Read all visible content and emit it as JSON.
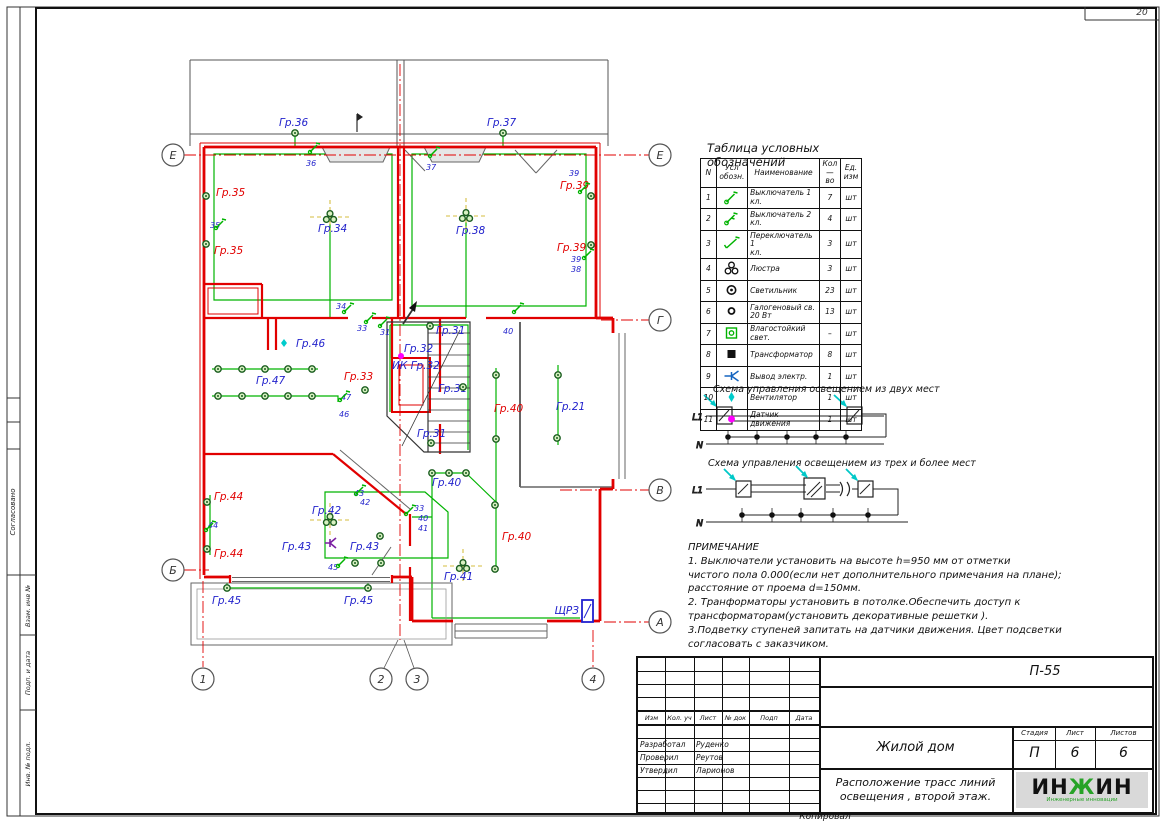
{
  "page": {
    "corner_number": "20",
    "copied_label": "Копировал"
  },
  "sidebar": {
    "agreed": "Согласовано",
    "vzam": "Взам. инв №",
    "podp": "Подп. и дата",
    "inv": "Инв. № подл."
  },
  "legend": {
    "title": "Таблица условных обозначений",
    "headers": {
      "n": "N",
      "symbol": "Усл\nобозн.",
      "name": "Наименование",
      "qty": "Кол\n—\nво",
      "unit": "Ед.\nизм"
    },
    "rows": [
      {
        "n": "1",
        "icon": "switch-1",
        "name": "Выключатель 1\nкл.",
        "qty": "7",
        "unit": "шт"
      },
      {
        "n": "2",
        "icon": "switch-2",
        "name": "Выключатель 2\nкл.",
        "qty": "4",
        "unit": "шт"
      },
      {
        "n": "3",
        "icon": "changeover",
        "name": "Переключатель 1\nкл.",
        "qty": "3",
        "unit": "шт"
      },
      {
        "n": "4",
        "icon": "chandelier",
        "name": "Люстра",
        "qty": "3",
        "unit": "шт"
      },
      {
        "n": "5",
        "icon": "lamp",
        "name": "Светильник",
        "qty": "23",
        "unit": "шт"
      },
      {
        "n": "6",
        "icon": "halogen",
        "name": "Галогеновый св.\n20 Вт",
        "qty": "13",
        "unit": "шт"
      },
      {
        "n": "7",
        "icon": "moistproof",
        "name": "Влагостойкий свет.",
        "qty": "–",
        "unit": "шт"
      },
      {
        "n": "8",
        "icon": "transformer",
        "name": "Трансформатор",
        "qty": "8",
        "unit": "шт"
      },
      {
        "n": "9",
        "icon": "outlet",
        "name": "Вывод электр.",
        "qty": "1",
        "unit": "шт"
      },
      {
        "n": "10",
        "icon": "fan",
        "name": "Вентилятор",
        "qty": "1",
        "unit": "шт"
      },
      {
        "n": "11",
        "icon": "motion",
        "name": "Датчик\nдвижения",
        "qty": "1",
        "unit": "шт"
      }
    ]
  },
  "schemes": [
    {
      "title": "Схема управления освещением из двух мест",
      "l1": "L1",
      "n": "N"
    },
    {
      "title": "Схема управления освещением из трех и более мест",
      "l1": "L1",
      "n": "N"
    }
  ],
  "notes": {
    "title": "ПРИМЕЧАНИЕ",
    "lines": [
      "1.   Выключатели установить   на высоте h=950 мм от отметки",
      "чистого пола 0.000(если нет дополнительного примечания на плане);",
      "расстояние от проема d=150мм.",
      "2.  Транформаторы установить в потолке.Обеспечить доступ к",
      "трансформаторам(установить декоративные решетки ).",
      "3.Подветку ступеней запитать на датчики движения. Цвет подсветки",
      "согласовать с заказчиком."
    ]
  },
  "title_block": {
    "doc_code": "П-55",
    "cols": [
      "Изм",
      "Кол. уч",
      "Лист",
      "№ док",
      "Подп",
      "Дата"
    ],
    "rows": [
      {
        "role": "Разработал",
        "name": "Руденко"
      },
      {
        "role": "Проверил",
        "name": "Реутов"
      },
      {
        "role": "Утвердил",
        "name": "Ларионов"
      }
    ],
    "project": "Жилой дом",
    "sheet_title_1": "Расположение трасс линий",
    "sheet_title_2": "освещения , второй этаж.",
    "stage_label": "Стадия",
    "sheet_label": "Лист",
    "sheets_label": "Листов",
    "stage": "П",
    "sheet": "6",
    "sheets": "6",
    "logo": "ИНЖИН",
    "logo_sub": "Инженерные инновации"
  },
  "plan": {
    "panel_label": "ЩРЗ",
    "colors": {
      "wall": "#e10000",
      "wire": "#00b300",
      "label_blue": "#2323cc",
      "label_red": "#e10000",
      "sensor": "#ff00ff",
      "fan": "#00cccc",
      "outlet": "#7b1fa2",
      "panel": "#2020d0"
    },
    "labels": [
      {
        "t": "Гр.36",
        "x": 279,
        "y": 126,
        "c": "blue"
      },
      {
        "t": "Гр.37",
        "x": 487,
        "y": 126,
        "c": "blue"
      },
      {
        "t": "Гр.35",
        "x": 216,
        "y": 196,
        "c": "red"
      },
      {
        "t": "Гр.35",
        "x": 214,
        "y": 254,
        "c": "red"
      },
      {
        "t": "Гр.39",
        "x": 560,
        "y": 189,
        "c": "red"
      },
      {
        "t": "Гр.39",
        "x": 557,
        "y": 251,
        "c": "red"
      },
      {
        "t": "Гр.34",
        "x": 318,
        "y": 232,
        "c": "blue"
      },
      {
        "t": "Гр.38",
        "x": 456,
        "y": 234,
        "c": "blue"
      },
      {
        "t": "Гр.46",
        "x": 296,
        "y": 347,
        "c": "blue"
      },
      {
        "t": "Гр.47",
        "x": 256,
        "y": 384,
        "c": "blue"
      },
      {
        "t": "Гр.33",
        "x": 344,
        "y": 380,
        "c": "red"
      },
      {
        "t": "Гр.31",
        "x": 436,
        "y": 334,
        "c": "blue"
      },
      {
        "t": "Гр.32",
        "x": 404,
        "y": 352,
        "c": "blue"
      },
      {
        "t": "ИК Гр.32",
        "x": 392,
        "y": 369,
        "c": "blue"
      },
      {
        "t": "Гр.31",
        "x": 438,
        "y": 392,
        "c": "blue"
      },
      {
        "t": "Гр.31",
        "x": 417,
        "y": 437,
        "c": "blue"
      },
      {
        "t": "Гр.21",
        "x": 556,
        "y": 410,
        "c": "blue"
      },
      {
        "t": "Гр.40",
        "x": 494,
        "y": 412,
        "c": "red"
      },
      {
        "t": "Гр.40",
        "x": 432,
        "y": 486,
        "c": "blue"
      },
      {
        "t": "Гр.40",
        "x": 502,
        "y": 540,
        "c": "red"
      },
      {
        "t": "Гр.41",
        "x": 444,
        "y": 580,
        "c": "blue"
      },
      {
        "t": "Гр.42",
        "x": 312,
        "y": 514,
        "c": "blue"
      },
      {
        "t": "Гр.43",
        "x": 282,
        "y": 550,
        "c": "blue"
      },
      {
        "t": "Гр.43",
        "x": 350,
        "y": 550,
        "c": "blue"
      },
      {
        "t": "Гр.44",
        "x": 214,
        "y": 500,
        "c": "red"
      },
      {
        "t": "Гр.44",
        "x": 214,
        "y": 557,
        "c": "red"
      },
      {
        "t": "Гр.45",
        "x": 212,
        "y": 604,
        "c": "blue"
      },
      {
        "t": "Гр.45",
        "x": 344,
        "y": 604,
        "c": "blue"
      }
    ],
    "numbers": [
      {
        "t": "35",
        "x": 210,
        "y": 228
      },
      {
        "t": "36",
        "x": 306,
        "y": 166
      },
      {
        "t": "37",
        "x": 426,
        "y": 170
      },
      {
        "t": "39",
        "x": 569,
        "y": 176
      },
      {
        "t": "39",
        "x": 571,
        "y": 262
      },
      {
        "t": "38",
        "x": 571,
        "y": 272
      },
      {
        "t": "34",
        "x": 336,
        "y": 309
      },
      {
        "t": "33",
        "x": 357,
        "y": 331
      },
      {
        "t": "31",
        "x": 380,
        "y": 335
      },
      {
        "t": "40",
        "x": 503,
        "y": 334
      },
      {
        "t": "47",
        "x": 341,
        "y": 400
      },
      {
        "t": "46",
        "x": 339,
        "y": 417
      },
      {
        "t": "44",
        "x": 208,
        "y": 528
      },
      {
        "t": "43",
        "x": 354,
        "y": 496
      },
      {
        "t": "42",
        "x": 360,
        "y": 505
      },
      {
        "t": "33",
        "x": 414,
        "y": 511
      },
      {
        "t": "40",
        "x": 418,
        "y": 521
      },
      {
        "t": "41",
        "x": 418,
        "y": 531
      },
      {
        "t": "45",
        "x": 328,
        "y": 570
      }
    ],
    "lamps": [
      [
        206,
        196
      ],
      [
        206,
        244
      ],
      [
        295,
        133
      ],
      [
        503,
        133
      ],
      [
        591,
        196
      ],
      [
        591,
        245
      ],
      [
        218,
        369
      ],
      [
        242,
        369
      ],
      [
        265,
        369
      ],
      [
        288,
        369
      ],
      [
        312,
        369
      ],
      [
        218,
        396
      ],
      [
        242,
        396
      ],
      [
        265,
        396
      ],
      [
        288,
        396
      ],
      [
        312,
        396
      ],
      [
        365,
        390
      ],
      [
        430,
        326
      ],
      [
        463,
        387
      ],
      [
        431,
        443
      ],
      [
        496,
        375
      ],
      [
        496,
        439
      ],
      [
        495,
        505
      ],
      [
        495,
        569
      ],
      [
        558,
        375
      ],
      [
        557,
        438
      ],
      [
        432,
        473
      ],
      [
        449,
        473
      ],
      [
        466,
        473
      ],
      [
        207,
        502
      ],
      [
        207,
        549
      ],
      [
        380,
        536
      ],
      [
        355,
        563
      ],
      [
        381,
        563
      ],
      [
        227,
        588
      ],
      [
        368,
        588
      ]
    ],
    "chandeliers": [
      [
        330,
        217
      ],
      [
        466,
        216
      ],
      [
        330,
        520
      ],
      [
        463,
        566
      ]
    ],
    "switches": [
      [
        216,
        228
      ],
      [
        310,
        152
      ],
      [
        430,
        156
      ],
      [
        580,
        192
      ],
      [
        584,
        258
      ],
      [
        344,
        312
      ],
      [
        366,
        322
      ],
      [
        380,
        326
      ],
      [
        514,
        312
      ],
      [
        340,
        400
      ],
      [
        206,
        530
      ],
      [
        356,
        494
      ],
      [
        406,
        514
      ],
      [
        338,
        566
      ]
    ],
    "fans": [
      [
        284,
        343
      ]
    ],
    "sensors": [
      [
        401,
        356
      ]
    ],
    "outlets": [
      [
        330,
        543
      ]
    ],
    "axes": [
      {
        "t": "Е",
        "x": 173,
        "y": 155
      },
      {
        "t": "Б",
        "x": 173,
        "y": 570
      },
      {
        "t": "Е",
        "x": 660,
        "y": 155
      },
      {
        "t": "Г",
        "x": 660,
        "y": 320
      },
      {
        "t": "В",
        "x": 660,
        "y": 490
      },
      {
        "t": "А",
        "x": 660,
        "y": 622
      },
      {
        "t": "1",
        "x": 203,
        "y": 679
      },
      {
        "t": "2",
        "x": 381,
        "y": 679
      },
      {
        "t": "3",
        "x": 417,
        "y": 679
      },
      {
        "t": "4",
        "x": 593,
        "y": 679
      }
    ]
  }
}
